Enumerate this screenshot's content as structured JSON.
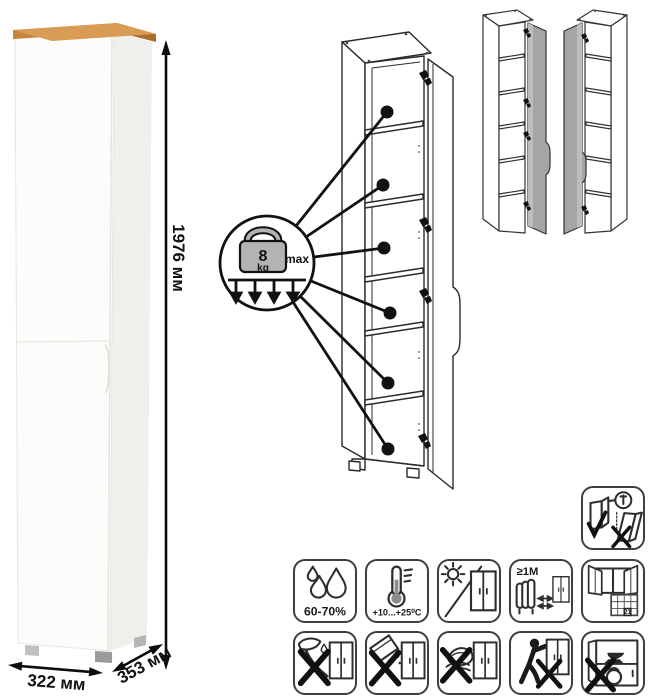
{
  "product": {
    "type": "tall-one-door-cabinet",
    "dimensions": {
      "height": "1976 мм",
      "width": "322 мм",
      "depth": "353 мм"
    }
  },
  "callout": {
    "weight_value": "8",
    "weight_unit": "kg",
    "weight_qualifier": "max",
    "shelf_callouts": 6
  },
  "variants": {
    "left_variant": "door-hinged-right",
    "right_variant": "door-hinged-left"
  },
  "care": {
    "humidity": "60-70%",
    "temperature": "+10...+25⁰C",
    "heat_distance": "≥1М",
    "calendar_day": "21"
  },
  "icon_names": [
    "anti-tip-wall-mount-icon",
    "humidity-icon",
    "temperature-range-icon",
    "avoid-direct-sunlight-icon",
    "keep-distance-from-heat-icon",
    "ventilate-room-icon",
    "no-sharp-tools-icon",
    "no-abrasive-cleaners-icon",
    "no-wet-cleaning-icon",
    "no-dragging-icon",
    "no-overloading-icon"
  ],
  "colors": {
    "wood_top": "#c5873c",
    "wood_top_dark": "#a96f2a",
    "cabinet_white": "#fcfcfa",
    "cabinet_side": "#efefeb",
    "drawing_line": "#2a2a2a",
    "door_gray": "#a5a5a5",
    "callout_black": "#111111"
  }
}
